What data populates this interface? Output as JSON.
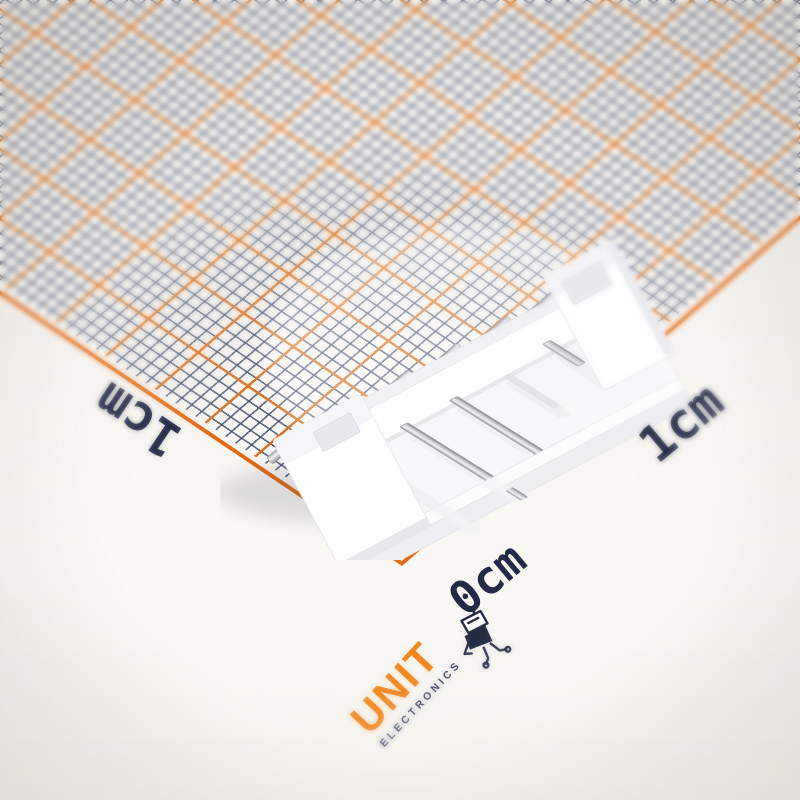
{
  "photo": {
    "type": "product-photo",
    "subject": "White 6-pin JST-PH style right-angle pin header connector on graph paper",
    "surface_color": "#f6f4f0"
  },
  "graph_paper": {
    "paper_color": "#f9f7f3",
    "minor_grid_color": "#48516c",
    "major_grid_color": "#db721c",
    "border_color": "#e4690e",
    "minor_spacing_px": 12,
    "major_every_n_cells": 5,
    "orientation": "rotated ~45deg, corner pointing down"
  },
  "ruler_labels": {
    "left": "1cm",
    "bottom": "0cm",
    "right": "1cm",
    "text_color": "#232946"
  },
  "brand": {
    "name": "UNIT",
    "tagline": "ELECTRONICS",
    "name_color": "#ef8418",
    "tagline_color": "#2a3052",
    "mascot": "robot-mascot-icon"
  },
  "connector": {
    "pin_count": 6,
    "body_color": "#ffffff",
    "pin_metal_color": "#c7c7cc"
  }
}
